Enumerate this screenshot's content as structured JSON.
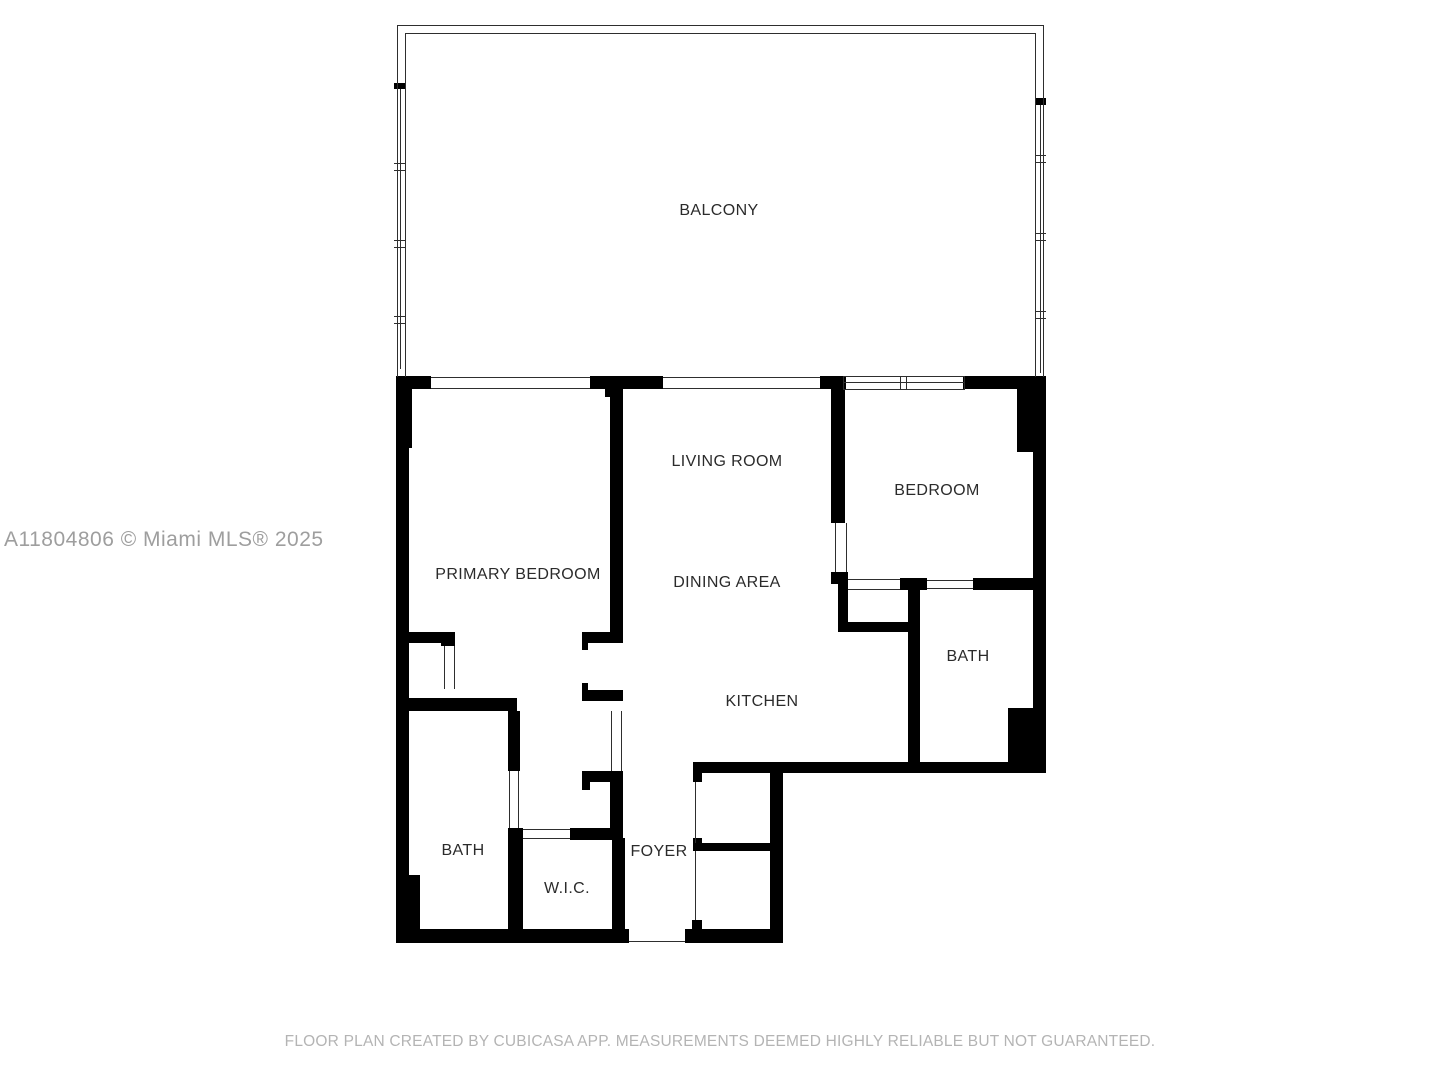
{
  "title": "Floor Plan",
  "rooms": {
    "balcony": "BALCONY",
    "living_room": "LIVING ROOM",
    "bedroom": "BEDROOM",
    "primary_bedroom": "PRIMARY BEDROOM",
    "dining_area": "DINING AREA",
    "bath_2": "BATH",
    "kitchen": "KITCHEN",
    "bath_primary": "BATH",
    "wic": "W.I.C.",
    "foyer": "FOYER"
  },
  "branding": {
    "watermark": "A11804806 © Miami MLS® 2025",
    "footer": "FLOOR PLAN CREATED BY CUBICASA APP. MEASUREMENTS DEEMED HIGHLY RELIABLE BUT NOT GUARANTEED."
  },
  "colors": {
    "wall": "#000000",
    "thin_line": "#2e2e2e",
    "label_text": "#2b2b2b",
    "watermark_text": "#9e9e9e",
    "footer_text": "#b4b4b4",
    "background": "#ffffff"
  }
}
